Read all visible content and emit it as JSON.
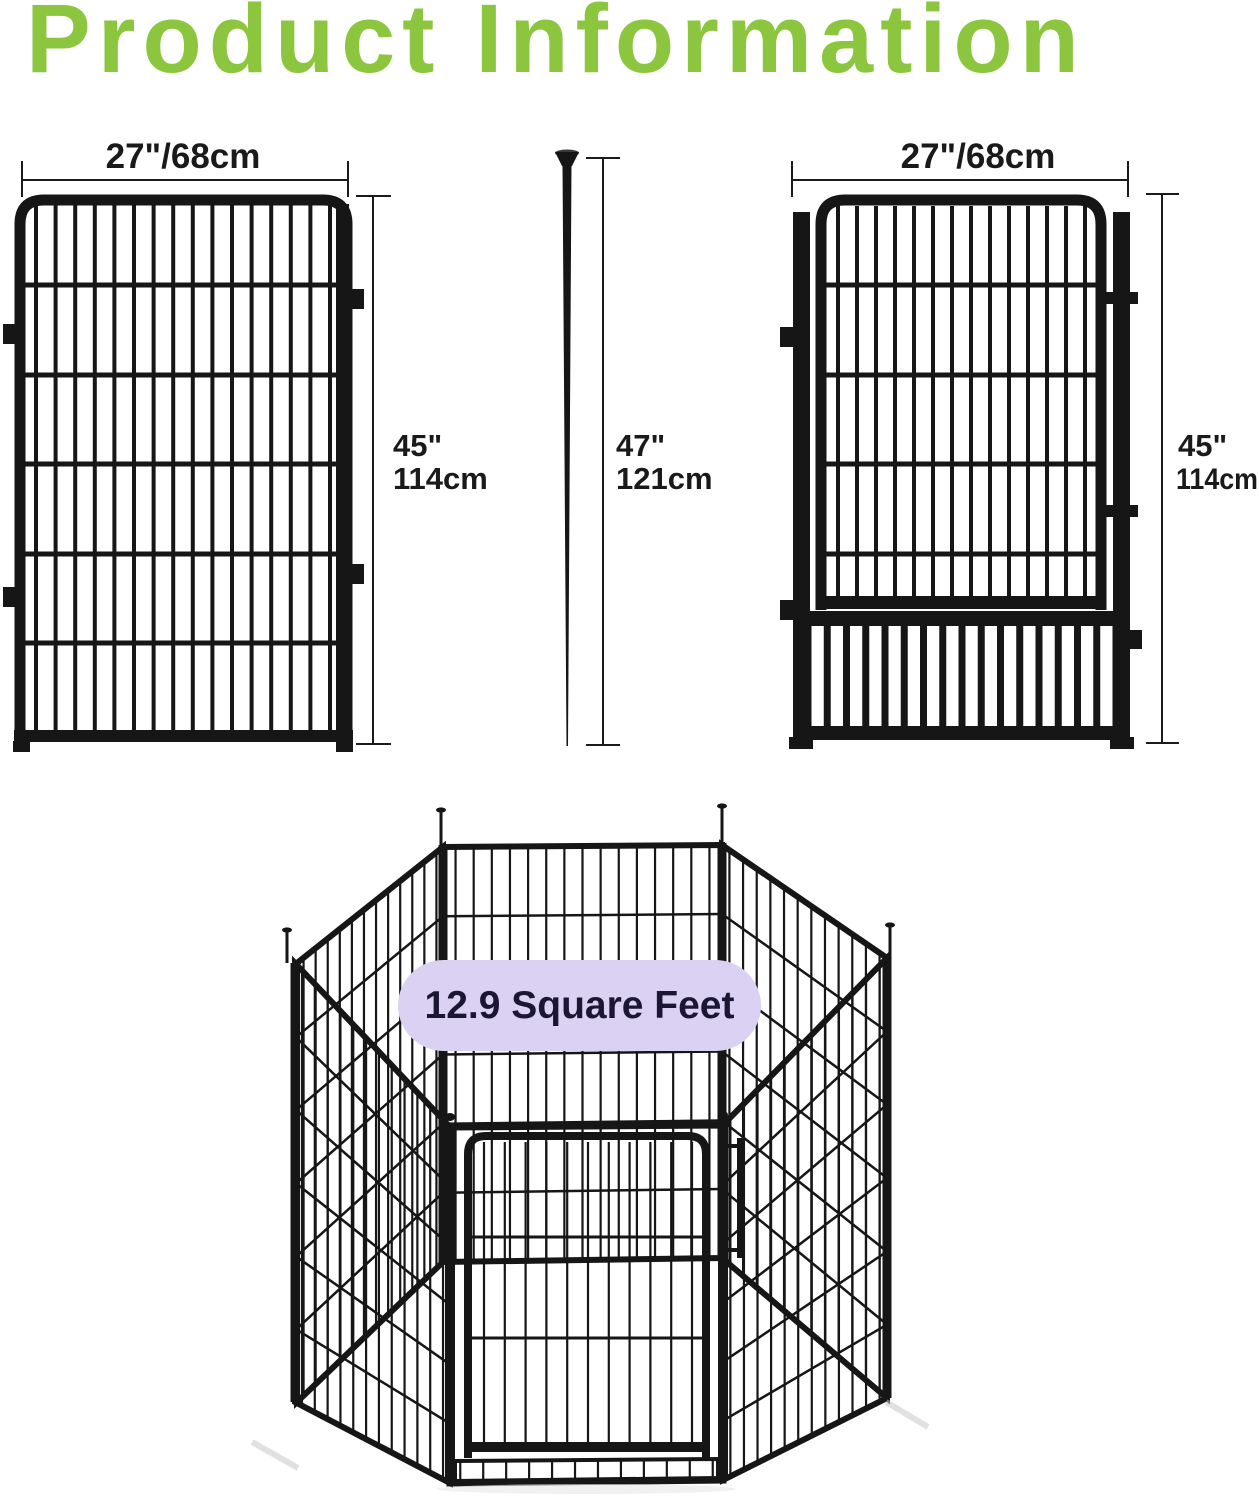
{
  "title": "Product Information",
  "panel": {
    "width": "27\"/68cm",
    "height_in": "45\"",
    "height_cm": "114cm"
  },
  "stake": {
    "height_in": "47\"",
    "height_cm": "121cm"
  },
  "gate": {
    "width": "27\"/68cm",
    "height_in": "45\"",
    "height_cm": "114cm"
  },
  "playpen": {
    "area": "12.9 Square Feet"
  },
  "colors": {
    "accent_green": "#8CC63F",
    "pill_bg": "#DBD1F2",
    "pill_text": "#1B1733",
    "ink": "#161616",
    "dim_line": "#1A1A1A"
  }
}
